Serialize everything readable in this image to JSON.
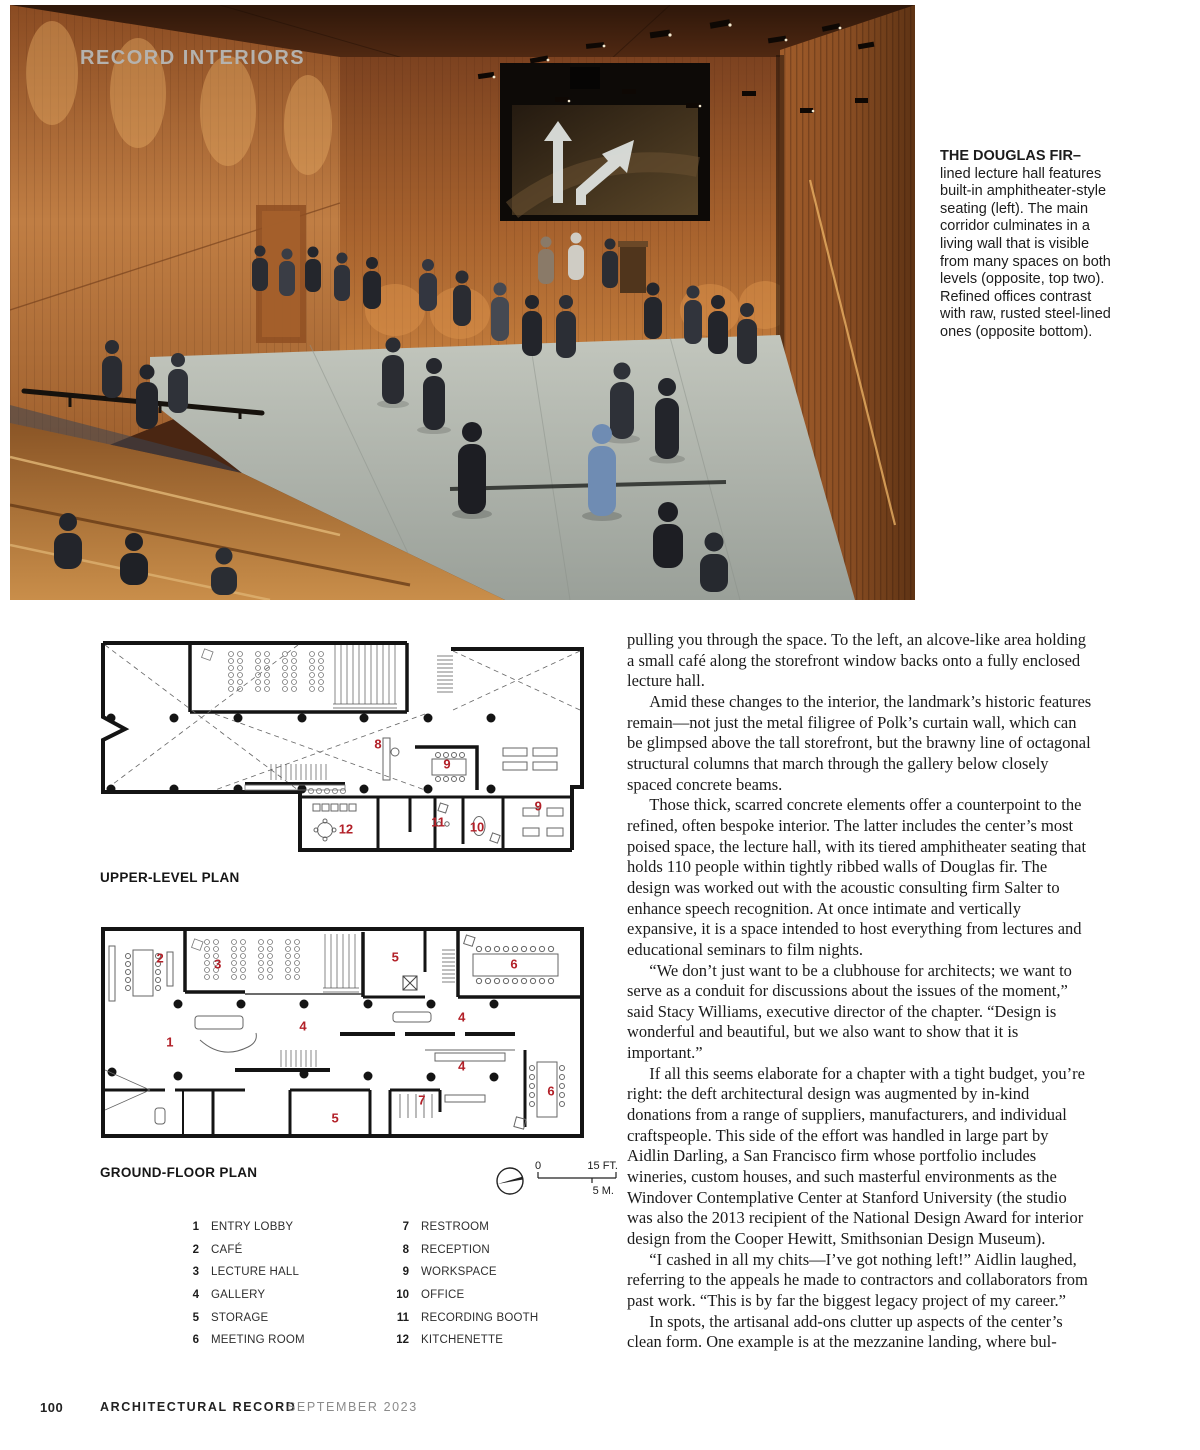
{
  "photo": {
    "kicker": "RECORD INTERIORS",
    "caption_lead": "THE DOUGLAS FIR–",
    "caption_body": "lined lecture hall features built-in amphitheater-style seating (left). The main corridor culminates in a living wall that is visible from many spaces on both levels (opposite, top two). Refined offices contrast with raw, rusted steel-lined ones (opposite bottom)."
  },
  "plans": {
    "upper": {
      "title": "UPPER-LEVEL PLAN",
      "markers": [
        {
          "n": "8",
          "x": 57.4,
          "y": 49.1
        },
        {
          "n": "9",
          "x": 71.4,
          "y": 57.9
        },
        {
          "n": "9",
          "x": 89.9,
          "y": 76.3
        },
        {
          "n": "11",
          "x": 69.6,
          "y": 83.3
        },
        {
          "n": "10",
          "x": 77.5,
          "y": 85.5
        },
        {
          "n": "12",
          "x": 50.9,
          "y": 86.4
        }
      ]
    },
    "ground": {
      "title": "GROUND-FLOOR PLAN",
      "markers": [
        {
          "n": "2",
          "x": 13.2,
          "y": 16.2
        },
        {
          "n": "3",
          "x": 24.9,
          "y": 18.9
        },
        {
          "n": "5",
          "x": 60.9,
          "y": 15.8
        },
        {
          "n": "6",
          "x": 85.0,
          "y": 18.9
        },
        {
          "n": "4",
          "x": 42.2,
          "y": 46.8
        },
        {
          "n": "4",
          "x": 74.4,
          "y": 42.8
        },
        {
          "n": "1",
          "x": 15.2,
          "y": 54.1
        },
        {
          "n": "4",
          "x": 74.4,
          "y": 64.9
        },
        {
          "n": "6",
          "x": 92.5,
          "y": 76.1
        },
        {
          "n": "7",
          "x": 66.3,
          "y": 80.2
        },
        {
          "n": "5",
          "x": 48.7,
          "y": 88.3
        }
      ]
    },
    "scale": {
      "zero": "0",
      "feet": "15 FT.",
      "meters": "5 M."
    },
    "legend_left": [
      {
        "n": "1",
        "label": "ENTRY LOBBY"
      },
      {
        "n": "2",
        "label": "CAFÉ"
      },
      {
        "n": "3",
        "label": "LECTURE HALL"
      },
      {
        "n": "4",
        "label": "GALLERY"
      },
      {
        "n": "5",
        "label": "STORAGE"
      },
      {
        "n": "6",
        "label": "MEETING ROOM"
      }
    ],
    "legend_right": [
      {
        "n": "7",
        "label": "RESTROOM"
      },
      {
        "n": "8",
        "label": "RECEPTION"
      },
      {
        "n": "9",
        "label": "WORKSPACE"
      },
      {
        "n": "10",
        "label": "OFFICE"
      },
      {
        "n": "11",
        "label": "RECORDING BOOTH"
      },
      {
        "n": "12",
        "label": "KITCHENETTE"
      }
    ]
  },
  "article": {
    "paragraphs": [
      "pulling you through the space. To the left, an alcove-like area holding a small café along the storefront window backs onto a fully enclosed lecture hall.",
      "Amid these changes to the interior, the landmark’s historic features remain—not just the metal filigree of Polk’s curtain wall, which can be glimpsed above the tall storefront, but the brawny line of octagonal structural columns that march through the gallery below closely spaced concrete beams.",
      "Those thick, scarred concrete elements offer a counterpoint to the refined, often bespoke interior. The latter includes the center’s most poised space, the lecture hall, with its tiered amphitheater seating that holds 110 people within tightly ribbed walls of Douglas fir. The design was worked out with the acoustic consulting firm Salter to enhance speech recognition. At once intimate and vertically expansive, it is a space intended to host everything from lectures and educational seminars to film nights.",
      "“We don’t just want to be a clubhouse for architects; we want to serve as a conduit for discussions about the issues of the moment,” said Stacy Williams, executive director of the chapter. “Design is wonderful and beautiful, but we also want to show that it is important.”",
      "If all this seems elaborate for a chapter with a tight budget, you’re right: the deft architectural design was augmented by in-kind donations from a range of suppliers, manufacturers, and individual craftspeople. This side of the effort was handled in large part by Aidlin Darling, a San Francisco firm whose portfolio includes wineries, custom houses, and such masterful environments as the Windover Contemplative Center at Stanford University (the studio was also the 2013 recipient of the National Design Award for interior design from the Cooper Hewitt, Smithsonian Design Museum).",
      "“I cashed in all my chits—I’ve got nothing left!” Aidlin laughed, referring to the appeals he made to contractors and collaborators from past work. “This is by far the biggest legacy project of my career.”",
      "In spots, the artisanal add-ons clutter up aspects of the center’s clean form. One example is at the mezzanine landing, where bul-"
    ]
  },
  "footer": {
    "page_number": "100",
    "magazine": "ARCHITECTURAL RECORD",
    "issue": "SEPTEMBER 2023"
  },
  "colors": {
    "plan_number": "#b22028",
    "kicker": "#b5b2ae",
    "wood_accent": "#b06a33"
  }
}
